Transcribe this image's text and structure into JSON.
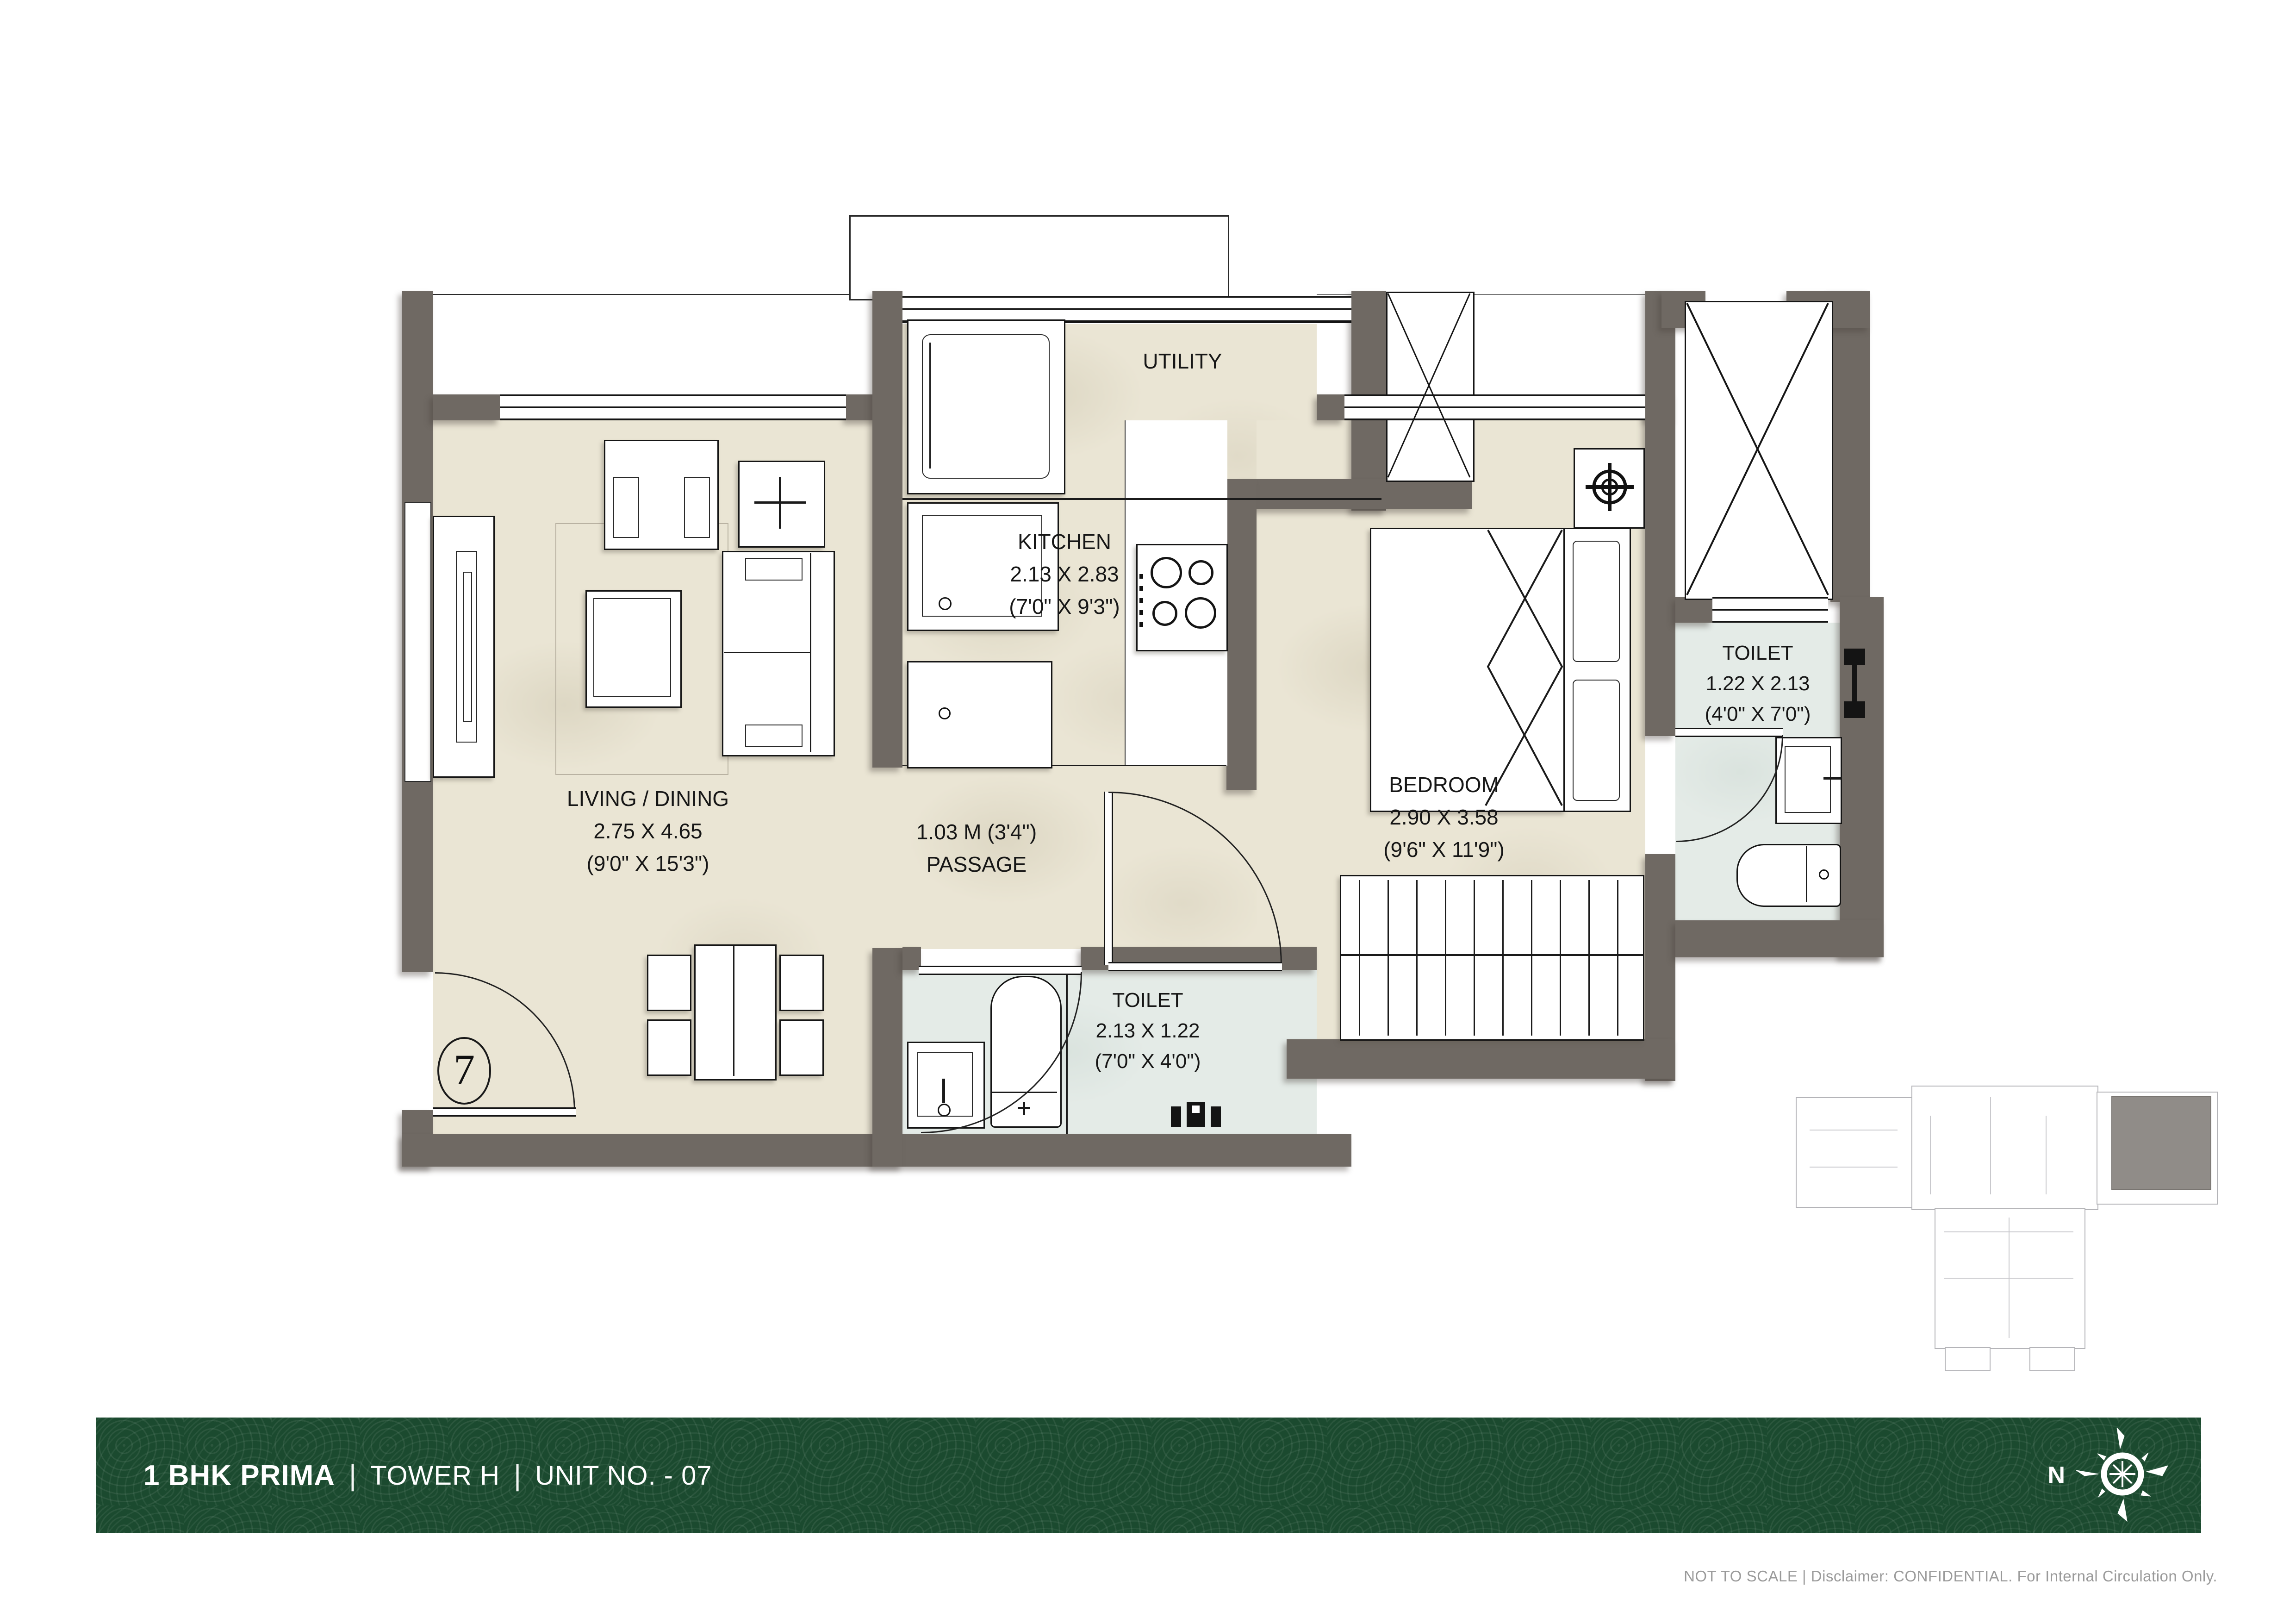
{
  "footer": {
    "title": "1 BHK PRIMA",
    "separator": "|",
    "tower": "TOWER H",
    "unit": "UNIT NO. - 07",
    "north_label": "N"
  },
  "disclaimer": "NOT TO SCALE | Disclaimer: CONFIDENTIAL. For Internal Circulation Only.",
  "unit_marker": "7",
  "rooms": {
    "living": {
      "label": "LIVING / DINING",
      "dim_m": "2.75 X 4.65",
      "dim_ft": "(9'0\" X 15'3\")"
    },
    "kitchen": {
      "label": "KITCHEN",
      "dim_m": "2.13 X 2.83",
      "dim_ft": "(7'0\" X 9'3\")"
    },
    "utility": {
      "label": "UTILITY"
    },
    "passage": {
      "dim": "1.03 M (3'4\")",
      "label": "PASSAGE"
    },
    "bedroom": {
      "label": "BEDROOM",
      "dim_m": "2.90 X 3.58",
      "dim_ft": "(9'6\" X 11'9\")"
    },
    "toilet_attached": {
      "label": "TOILET",
      "dim_m": "1.22 X 2.13",
      "dim_ft": "(4'0\" X 7'0\")"
    },
    "toilet_common": {
      "label": "TOILET",
      "dim_m": "2.13 X 1.22",
      "dim_ft": "(7'0\" X 4'0\")"
    }
  },
  "colors": {
    "wall": "#6f6963",
    "floor": "#eae5d4",
    "toilet_floor": "#e4ebe7",
    "footer_green": "#1b4a2f",
    "keyplan_highlight": "#908c88"
  }
}
